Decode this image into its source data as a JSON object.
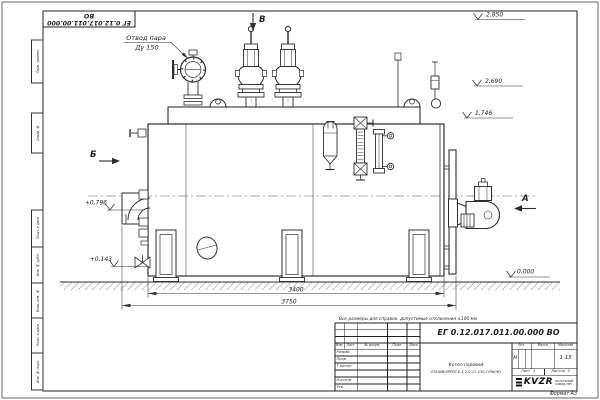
{
  "sheet": {
    "stamp_number": "ЕГ 0.12.017.011.00.000  ВО",
    "format_label": "Формат А3"
  },
  "margin_labels": [
    "Перв. примен.",
    "Справ. №",
    "Подп. и дата",
    "Инв. № дубл.",
    "Взам. инв. №",
    "Подп. и дата",
    "Инв. № подл."
  ],
  "drawing": {
    "callout": {
      "line1": "Отвод пара",
      "line2": "Ду 150"
    },
    "views": {
      "a": "А",
      "b": "Б",
      "v": "В"
    },
    "elevations": {
      "e2850": "2,850",
      "e2690": "2,690",
      "e1746": "1,746",
      "e0796": "+0,796",
      "e0143": "+0,143",
      "e0000": "0,000"
    },
    "dims": {
      "body": "3400",
      "overall": "3750"
    },
    "note": "Все размеры для справок, допустимые отклонения ±100 мм"
  },
  "title_block": {
    "designation": "ЕГ 0.12.017.011.00.000  ВО",
    "product_line1": "Котел паровой",
    "product_line2": "STEAMEXPERT-Е-1,2-0,17-130-ГЛЖ(Ж)",
    "cols": {
      "izm": "Изм.",
      "list": "Лист",
      "doc": "№ докум.",
      "podp": "Подп.",
      "date": "Дата"
    },
    "rows": {
      "razrab": "Разраб.",
      "prov": "Пров.",
      "tkontr": "Т.контр.",
      "nkontr": "Н.контр.",
      "utv": "Утв."
    },
    "lit_header": "Лит.",
    "lit_value": "М",
    "mass_header": "Масса",
    "scale_header": "Масштаб",
    "scale_value": "1:15",
    "sheet_label": "Лист",
    "sheet_value": "1",
    "sheets_label": "Листов",
    "sheets_value": "2",
    "company_logo": "KVZR",
    "company_line1": "КОТЕЛЬНЫЙ",
    "company_line2": "ЗАВОД РЭП"
  }
}
